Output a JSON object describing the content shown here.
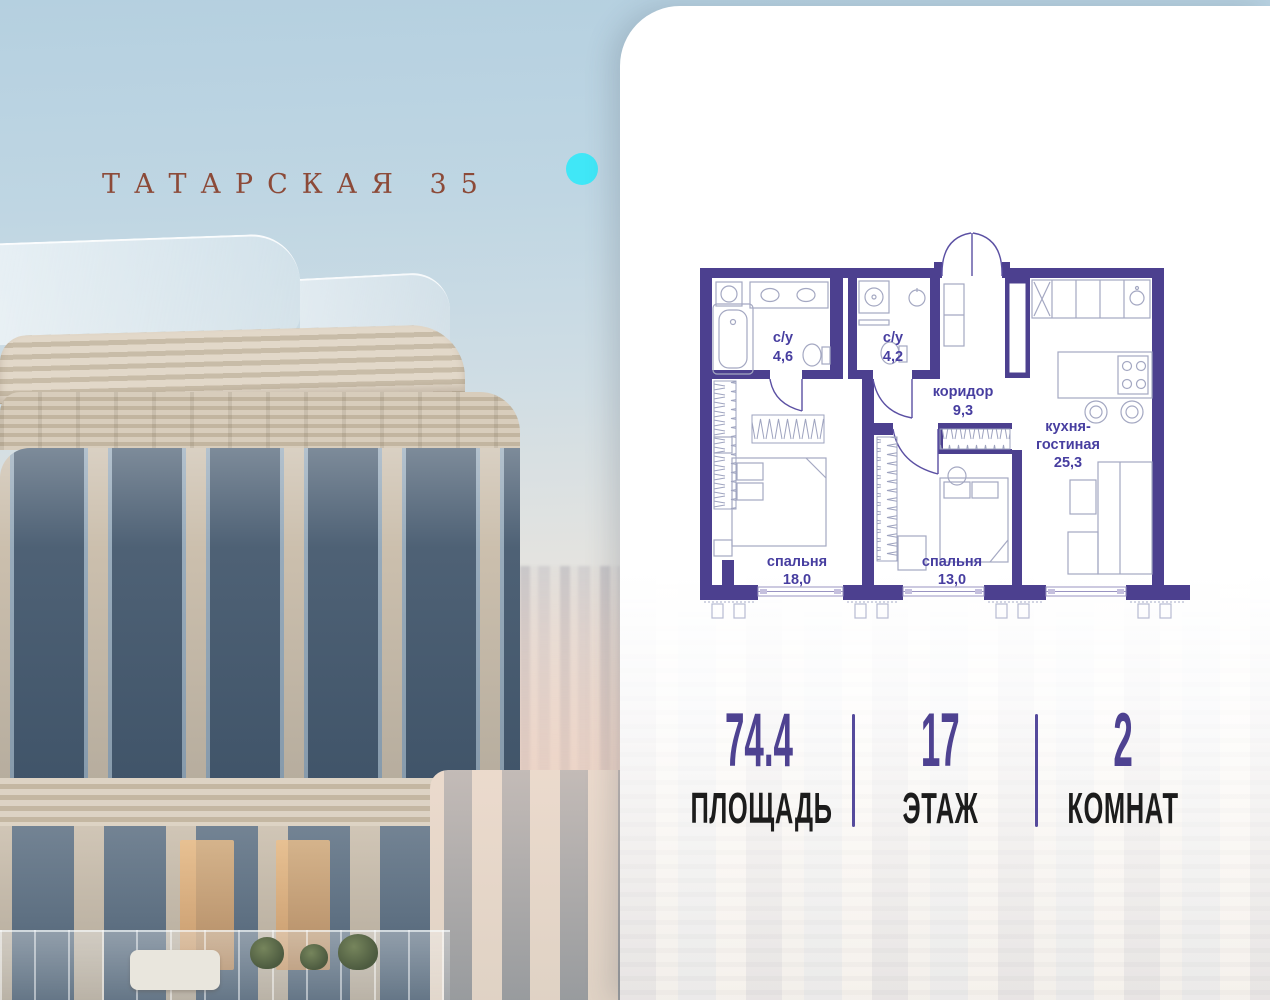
{
  "brand": {
    "title": "ТАТАРСКАЯ 35"
  },
  "card": {
    "floor_plan": {
      "rooms": [
        {
          "id": "bathroom-1",
          "label": "с/у",
          "area": "4,6"
        },
        {
          "id": "bathroom-2",
          "label": "с/у",
          "area": "4,2"
        },
        {
          "id": "corridor",
          "label": "коридор",
          "area": "9,3"
        },
        {
          "id": "kitchen-living",
          "label_line1": "кухня-",
          "label_line2": "гостиная",
          "area": "25,3"
        },
        {
          "id": "bedroom-1",
          "label": "спальня",
          "area": "18,0"
        },
        {
          "id": "bedroom-2",
          "label": "спальня",
          "area": "13,0"
        }
      ]
    },
    "stats": [
      {
        "value": "74.4",
        "label": "ПЛОЩАДЬ"
      },
      {
        "value": "17",
        "label": "ЭТАЖ"
      },
      {
        "value": "2",
        "label": "КОМНАТ"
      }
    ]
  },
  "colors": {
    "wall": "#4c408f",
    "room_label": "#473ea0",
    "stat_value": "#4e4291",
    "stat_label": "#1c1c1c",
    "brand_text": "#8c4a38",
    "accent_dot": "#40e7f7"
  }
}
